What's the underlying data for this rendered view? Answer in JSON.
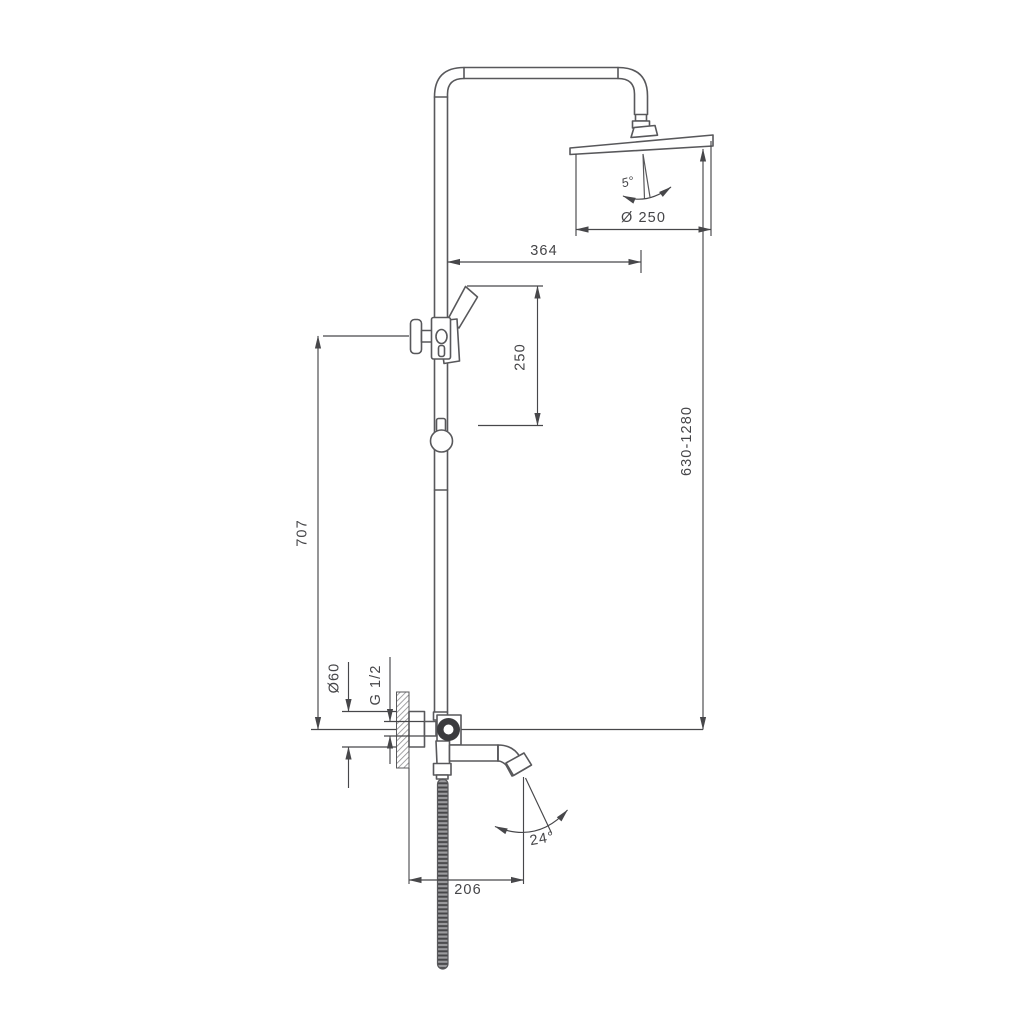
{
  "meta": {
    "drawing_type": "technical dimension drawing",
    "subject": "shower column system with overhead rain shower, hand shower, mixer valve and swivel spout"
  },
  "labels": {
    "head_diameter": "Ø 250",
    "head_tilt_angle": "5°",
    "arm_reach": "364",
    "hand_shower_travel": "250",
    "riser_height": "707",
    "overall_height_range": "630-1280",
    "escutcheon_diameter": "Ø60",
    "connection_size": "G 1/2",
    "spout_projection": "206",
    "spout_swivel_angle": "24°"
  },
  "colors": {
    "bg": "#ffffff",
    "line": "#58585b",
    "dim": "#47474a",
    "text": "#454548",
    "dark": "#3b3b3e",
    "hatch": "#8c8c8f"
  }
}
